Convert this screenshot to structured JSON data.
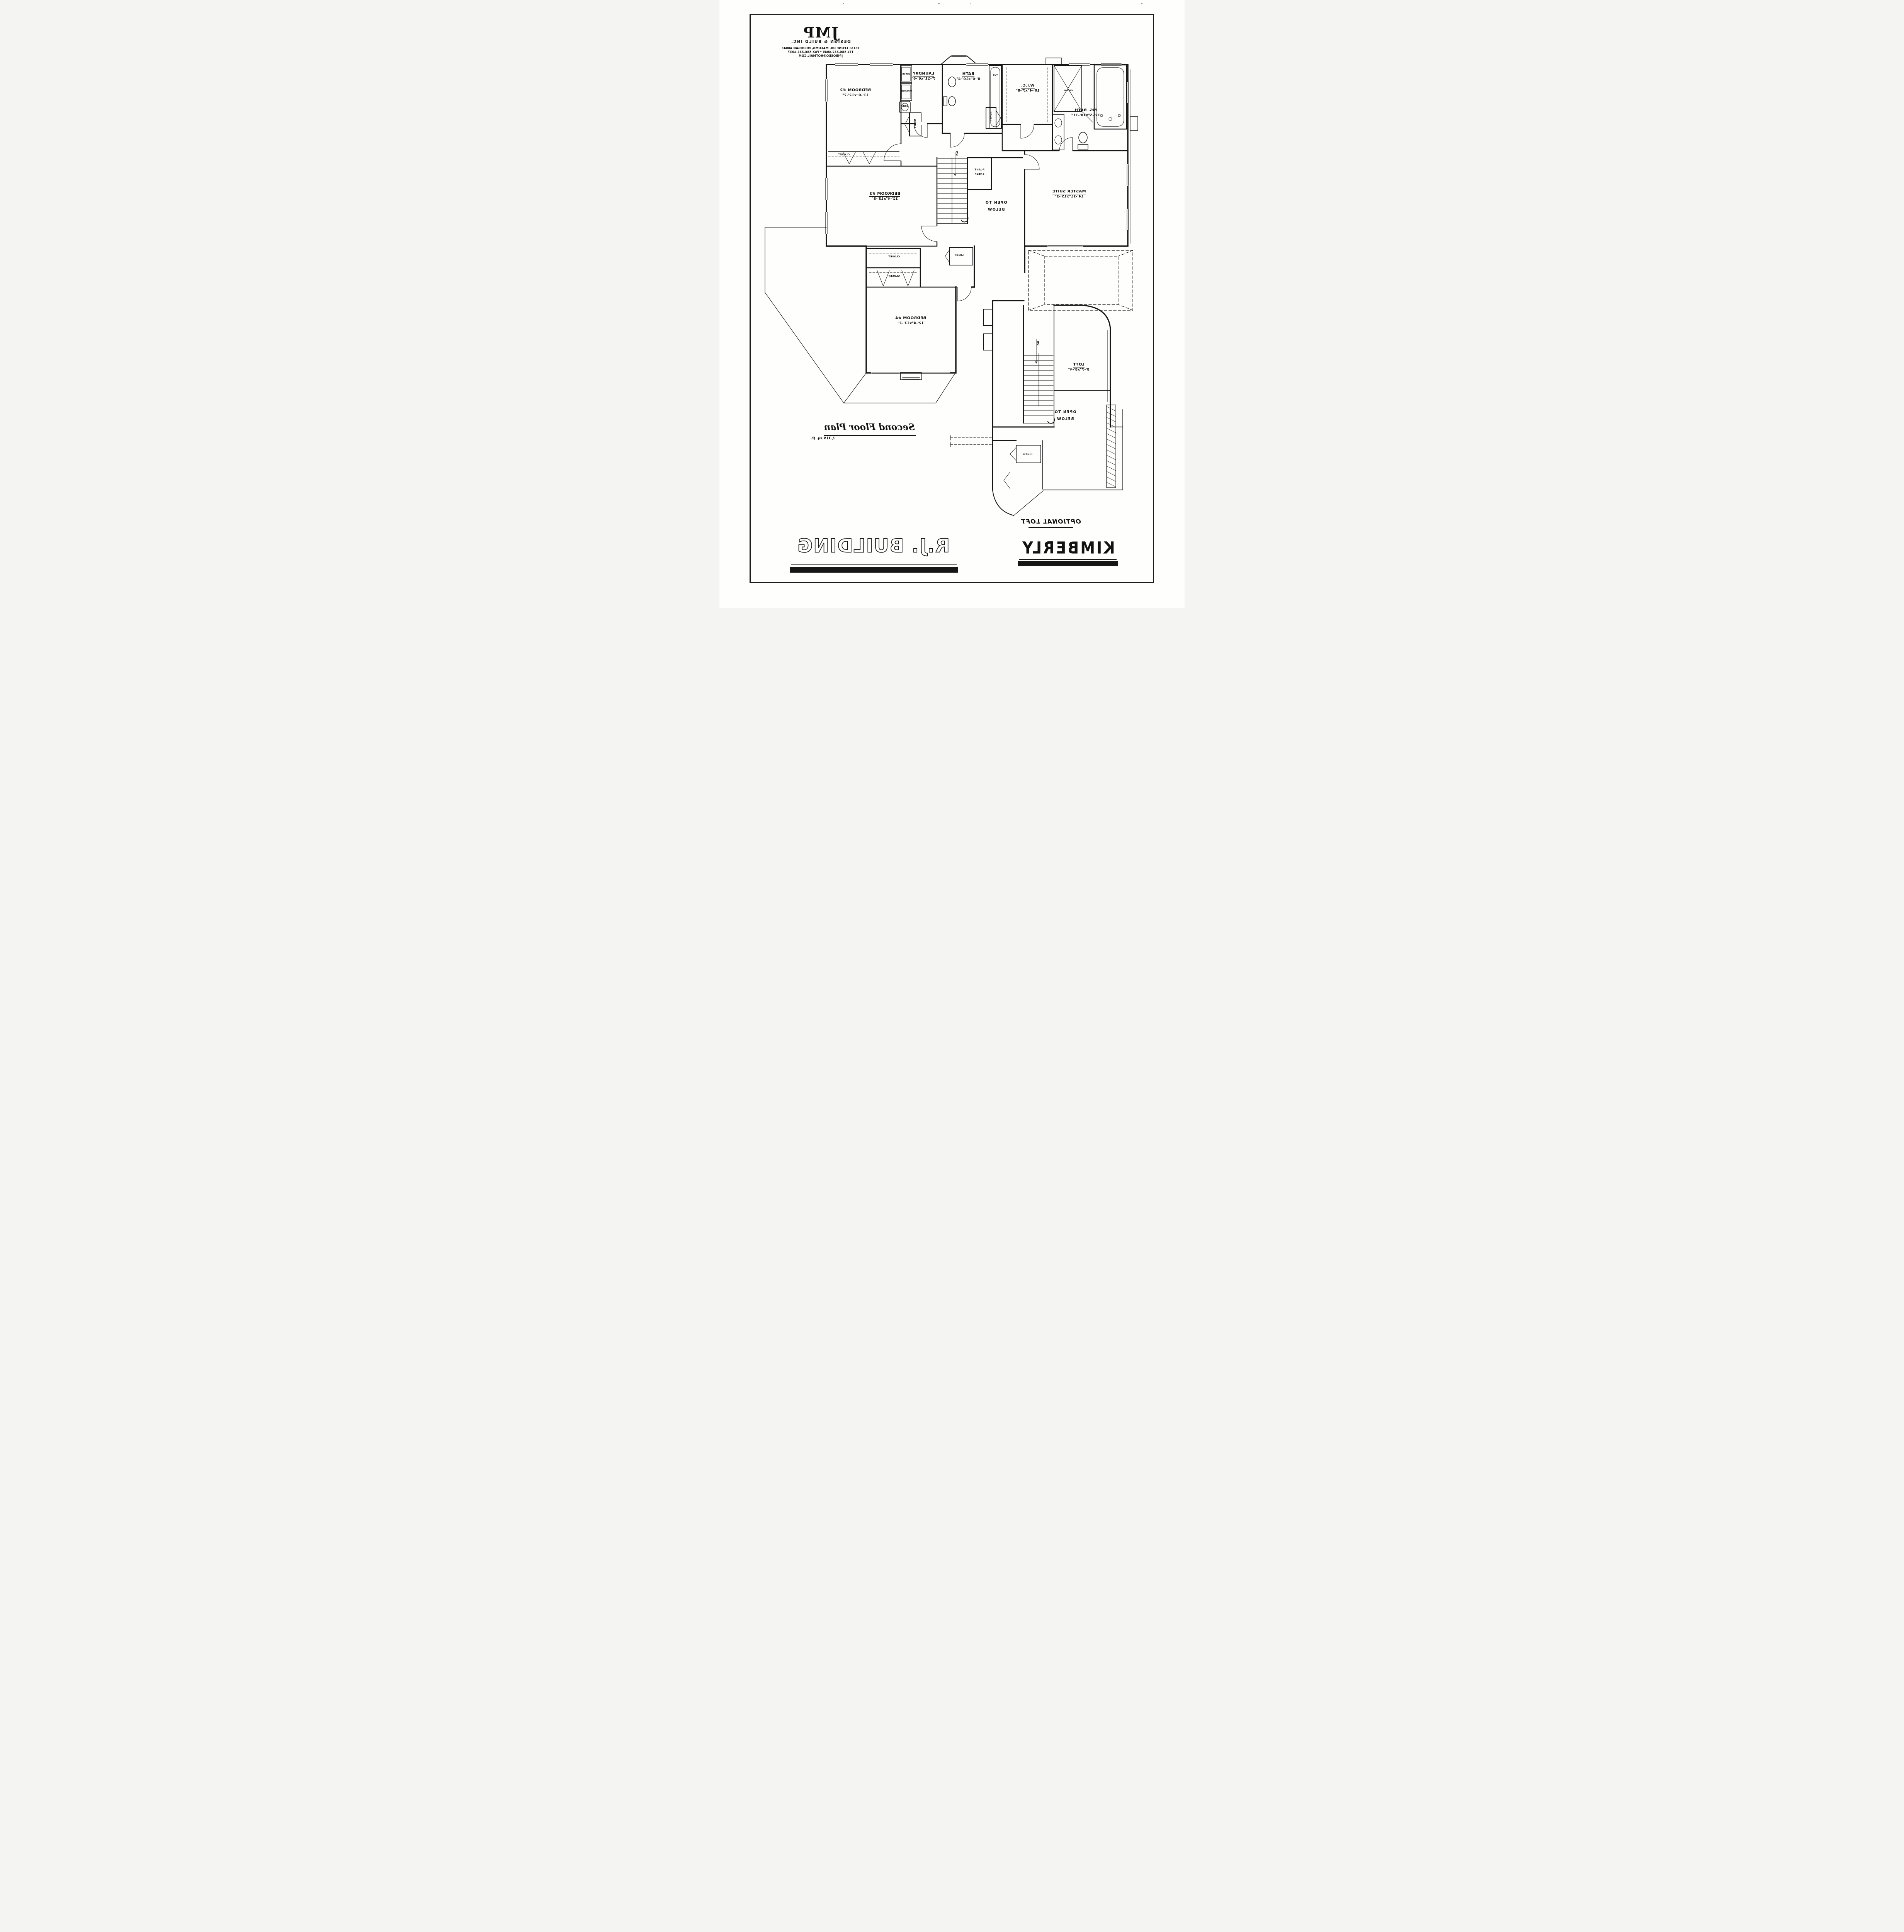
{
  "firm": {
    "logo": "JMP",
    "tagline": "DESIGN & BUILD INC.",
    "address": "16161 LEONE DR. MACOMB, MICHIGAN 48042",
    "phone": "TEL 586.232.4045 * FAX 586.232.4037",
    "email": "JPIROSKO@HOTMAIL.COM"
  },
  "titles": {
    "plan_name": "Second Floor Plan",
    "plan_area": "1,319 sq. ft.",
    "optional_loft": "OPTIONAL LOFT",
    "model": "KIMBERLY",
    "builder": "R.J. BUILDING"
  },
  "rooms": {
    "bedroom2": {
      "name": "BEDROOM #2",
      "dims": "11'-0\"x12'-7\""
    },
    "laundry": {
      "name": "LAUNDRY",
      "dims": "7'-11\"x6'-6\""
    },
    "bath": {
      "name": "BATH",
      "dims": "8'-0\"x10'-4\""
    },
    "wic": {
      "name": "W.I.C.",
      "dims": "10'-4\"x7'-8\""
    },
    "ms_bath": {
      "name": "MS. BATH",
      "dims": "12'-5\"x10'-11\""
    },
    "master": {
      "name": "MASTER SUITE",
      "dims": "14'-11\"x15'-2\""
    },
    "bedroom3": {
      "name": "BEDROOM #3",
      "dims": "12'-4\"x13'-5\""
    },
    "bedroom4": {
      "name": "BEDROOM #4",
      "dims": "12'-4\"x13'-2\""
    },
    "loft": {
      "name": "LOFT",
      "dims": "8'-7\"x8'-4\""
    }
  },
  "labels": {
    "closet": "CLOSET",
    "linen": "LINEN",
    "dn": "DN",
    "open_to": "OPEN TO",
    "below": "BELOW",
    "plant": "PLANT",
    "shelf": "SHELF",
    "washer": "WASHER",
    "dryer": "DRYER",
    "sink": "SINK",
    "tub": "TUB",
    "shower": "shower"
  }
}
